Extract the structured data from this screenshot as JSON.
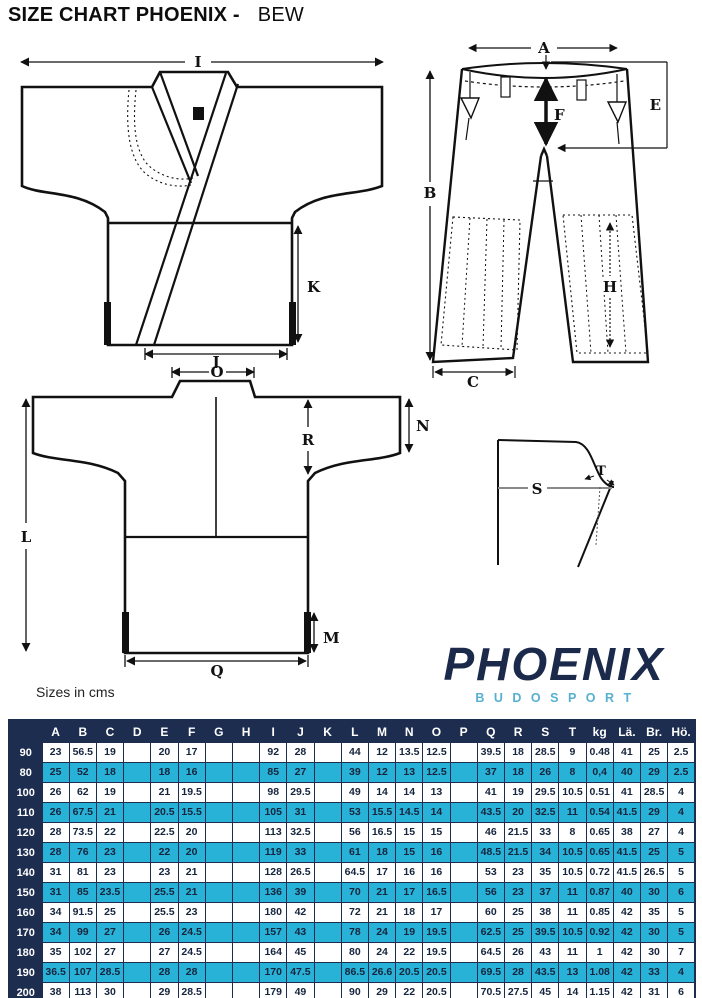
{
  "title": {
    "main": "SIZE CHART PHOENIX -",
    "variant": "BEW"
  },
  "note": "Sizes in cms",
  "logo": {
    "brand": "PHOENIX",
    "subtitle": "BUDOSPORT"
  },
  "diagram_labels": {
    "jacket_front": {
      "width_top": "I",
      "side_vent": "K",
      "hem_width": "J"
    },
    "pants": {
      "waist_width": "A",
      "outseam": "B",
      "leg_opening": "C",
      "rise_side": "E",
      "front_rise": "F",
      "knee_pad": "H"
    },
    "jacket_back": {
      "collar_width": "O",
      "sleeve_opening": "N",
      "sleeve_drop": "R",
      "total_length": "L",
      "vent_height": "M",
      "hem_width": "Q"
    },
    "collar_detail": {
      "shoulder_line": "S",
      "collar_width": "T"
    }
  },
  "colors": {
    "header_bg": "#1d2d4f",
    "row_shaded_bg": "#29b2d7",
    "row_plain_bg": "#ffffff",
    "cell_text": "#16243d",
    "header_text": "#ffffff",
    "brand": "#1b2a4a",
    "brand_sub": "#56b0d2"
  },
  "table": {
    "header": [
      "",
      "A",
      "B",
      "C",
      "D",
      "E",
      "F",
      "G",
      "H",
      "I",
      "J",
      "K",
      "L",
      "M",
      "N",
      "O",
      "P",
      "Q",
      "R",
      "S",
      "T",
      "kg",
      "Lä.",
      "Br.",
      "Hö."
    ],
    "rows": [
      {
        "size": "90",
        "shaded": false,
        "values": [
          "23",
          "56.5",
          "19",
          "",
          "20",
          "17",
          "",
          "",
          "92",
          "28",
          "",
          "44",
          "12",
          "13.5",
          "12.5",
          "",
          "39.5",
          "18",
          "28.5",
          "9",
          "0.48",
          "41",
          "25",
          "2.5"
        ]
      },
      {
        "size": "80",
        "shaded": true,
        "values": [
          "25",
          "52",
          "18",
          "",
          "18",
          "16",
          "",
          "",
          "85",
          "27",
          "",
          "39",
          "12",
          "13",
          "12.5",
          "",
          "37",
          "18",
          "26",
          "8",
          "0,4",
          "40",
          "29",
          "2.5"
        ]
      },
      {
        "size": "100",
        "shaded": false,
        "values": [
          "26",
          "62",
          "19",
          "",
          "21",
          "19.5",
          "",
          "",
          "98",
          "29.5",
          "",
          "49",
          "14",
          "14",
          "13",
          "",
          "41",
          "19",
          "29.5",
          "10.5",
          "0.51",
          "41",
          "28.5",
          "4"
        ]
      },
      {
        "size": "110",
        "shaded": true,
        "values": [
          "26",
          "67.5",
          "21",
          "",
          "20.5",
          "15.5",
          "",
          "",
          "105",
          "31",
          "",
          "53",
          "15.5",
          "14.5",
          "14",
          "",
          "43.5",
          "20",
          "32.5",
          "11",
          "0.54",
          "41.5",
          "29",
          "4"
        ]
      },
      {
        "size": "120",
        "shaded": false,
        "values": [
          "28",
          "73.5",
          "22",
          "",
          "22.5",
          "20",
          "",
          "",
          "113",
          "32.5",
          "",
          "56",
          "16.5",
          "15",
          "15",
          "",
          "46",
          "21.5",
          "33",
          "8",
          "0.65",
          "38",
          "27",
          "4"
        ]
      },
      {
        "size": "130",
        "shaded": true,
        "values": [
          "28",
          "76",
          "23",
          "",
          "22",
          "20",
          "",
          "",
          "119",
          "33",
          "",
          "61",
          "18",
          "15",
          "16",
          "",
          "48.5",
          "21.5",
          "34",
          "10.5",
          "0.65",
          "41.5",
          "25",
          "5"
        ]
      },
      {
        "size": "140",
        "shaded": false,
        "values": [
          "31",
          "81",
          "23",
          "",
          "23",
          "21",
          "",
          "",
          "128",
          "26.5",
          "",
          "64.5",
          "17",
          "16",
          "16",
          "",
          "53",
          "23",
          "35",
          "10.5",
          "0.72",
          "41.5",
          "26.5",
          "5"
        ]
      },
      {
        "size": "150",
        "shaded": true,
        "values": [
          "31",
          "85",
          "23.5",
          "",
          "25.5",
          "21",
          "",
          "",
          "136",
          "39",
          "",
          "70",
          "21",
          "17",
          "16.5",
          "",
          "56",
          "23",
          "37",
          "11",
          "0.87",
          "40",
          "30",
          "6"
        ]
      },
      {
        "size": "160",
        "shaded": false,
        "values": [
          "34",
          "91.5",
          "25",
          "",
          "25.5",
          "23",
          "",
          "",
          "180",
          "42",
          "",
          "72",
          "21",
          "18",
          "17",
          "",
          "60",
          "25",
          "38",
          "11",
          "0.85",
          "42",
          "35",
          "5"
        ]
      },
      {
        "size": "170",
        "shaded": true,
        "values": [
          "34",
          "99",
          "27",
          "",
          "26",
          "24.5",
          "",
          "",
          "157",
          "43",
          "",
          "78",
          "24",
          "19",
          "19.5",
          "",
          "62.5",
          "25",
          "39.5",
          "10.5",
          "0.92",
          "42",
          "30",
          "5"
        ]
      },
      {
        "size": "180",
        "shaded": false,
        "values": [
          "35",
          "102",
          "27",
          "",
          "27",
          "24.5",
          "",
          "",
          "164",
          "45",
          "",
          "80",
          "24",
          "22",
          "19.5",
          "",
          "64.5",
          "26",
          "43",
          "11",
          "1",
          "42",
          "30",
          "7"
        ]
      },
      {
        "size": "190",
        "shaded": true,
        "values": [
          "36.5",
          "107",
          "28.5",
          "",
          "28",
          "28",
          "",
          "",
          "170",
          "47.5",
          "",
          "86.5",
          "26.6",
          "20.5",
          "20.5",
          "",
          "69.5",
          "28",
          "43.5",
          "13",
          "1.08",
          "42",
          "33",
          "4"
        ]
      },
      {
        "size": "200",
        "shaded": false,
        "values": [
          "38",
          "113",
          "30",
          "",
          "29",
          "28.5",
          "",
          "",
          "179",
          "49",
          "",
          "90",
          "29",
          "22",
          "20.5",
          "",
          "70.5",
          "27.5",
          "45",
          "14",
          "1.15",
          "42",
          "31",
          "6"
        ]
      }
    ]
  }
}
